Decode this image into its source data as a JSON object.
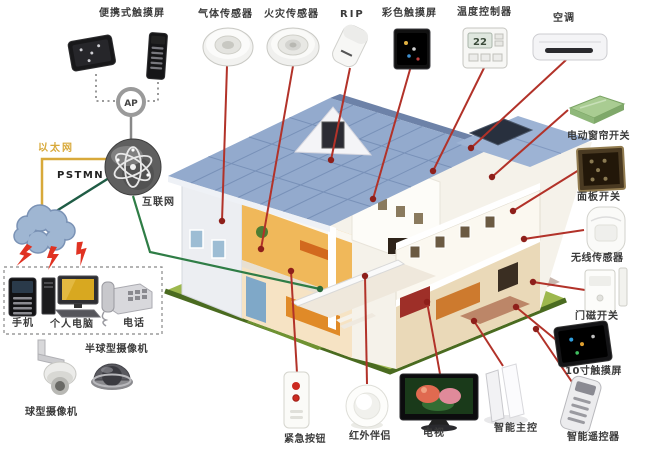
{
  "diagram": {
    "network": {
      "ap": "AP",
      "internet": "互联网",
      "ethernet": "以太网",
      "pstn": "PSTMN"
    },
    "devices": {
      "portable_touchscreen": "便携式触摸屏",
      "gas_sensor": "气体传感器",
      "fire_sensor": "火灾传感器",
      "pir": "RIP",
      "color_touchscreen": "彩色触摸屏",
      "temperature_controller": "温度控制器",
      "temperature_value": "22",
      "air_conditioner": "空调",
      "curtain_switch": "电动窗帘开关",
      "panel_switch": "面板开关",
      "wireless_sensor": "无线传感器",
      "door_magnet_switch": "门磁开关",
      "touchscreen_10inch": "10寸触摸屏",
      "smart_remote": "智能遥控器",
      "smart_main_control": "智能主控",
      "tv": "电视",
      "ir_companion": "红外伴侣",
      "emergency_button": "紧急按钮",
      "mobile_phone": "手机",
      "personal_computer": "个人电脑",
      "telephone": "电话",
      "dome_camera": "半球型摄像机",
      "ball_camera": "球型摄像机"
    },
    "colors": {
      "line_red": "#b23229",
      "line_green": "#2f7d46",
      "ethernet_yellow": "#d8a93a",
      "lawn_green": "#9db84e",
      "roof_blue": "#93aacd",
      "cloud_blue": "#9fb6d2"
    }
  }
}
